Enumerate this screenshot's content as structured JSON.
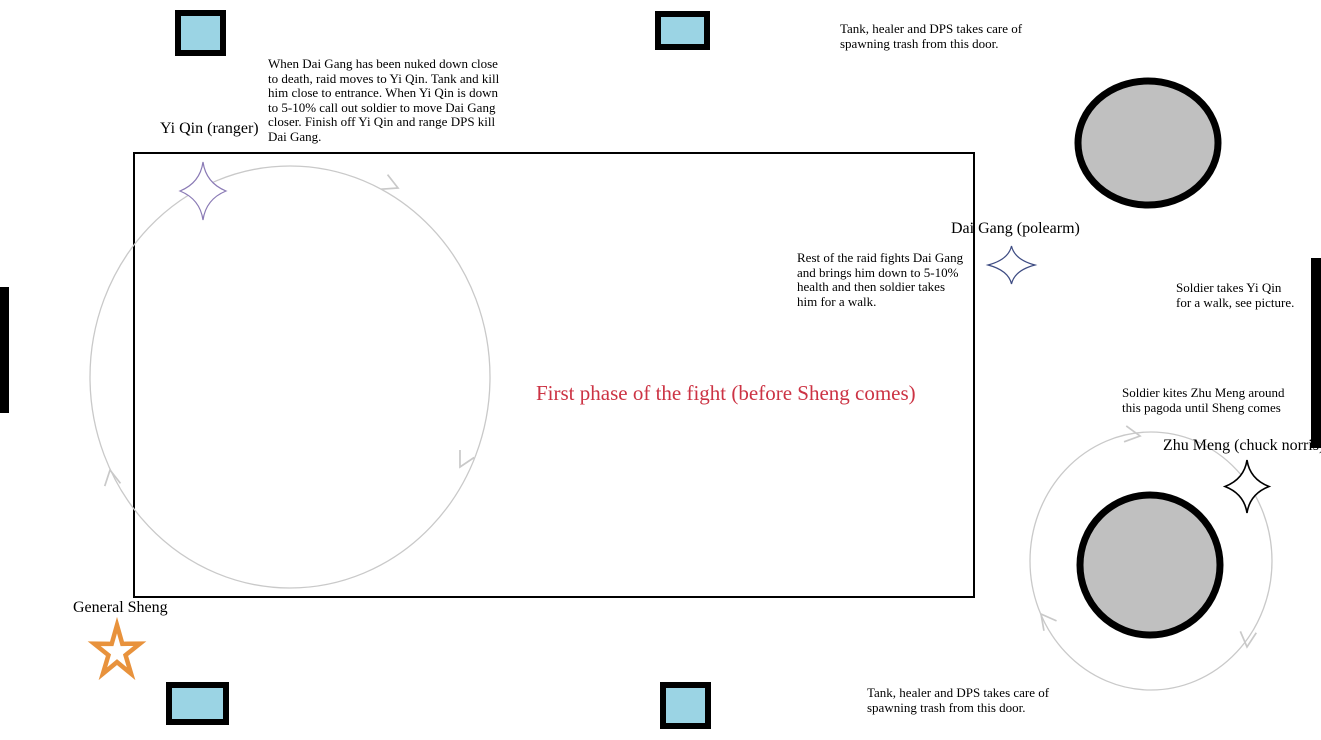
{
  "colors": {
    "door_fill": "#9bd4e4",
    "pagoda_fill": "#c0c0c0",
    "path_stroke": "#c9c9c9",
    "phase_title": "#cc3344",
    "yi_qin_star": "#8a7ab5",
    "dai_gang_star": "#3d4b82",
    "zhu_meng_star": "#000000",
    "sheng_star": "#e8923c"
  },
  "phase_title": "First phase of the fight (before Sheng comes)",
  "labels": {
    "yi_qin": "Yi Qin (ranger)",
    "dai_gang": "Dai Gang (polearm)",
    "zhu_meng": "Zhu Meng (chuck norris)",
    "general_sheng": "General Sheng"
  },
  "notes": {
    "strategy": "When Dai Gang has been nuked down close\nto death, raid moves to Yi Qin. Tank and kill\nhim close to entrance. When Yi Qin is down\nto 5-10% call out soldier to move Dai Gang\ncloser. Finish off Yi Qin and range DPS kill\nDai Gang.",
    "trash_top": "Tank, healer and DPS takes care of\nspawning trash from this door.",
    "rest_raid": "Rest of the raid fights Dai Gang\nand brings him down to 5-10%\nhealth and then soldier takes\nhim for a walk.",
    "soldier_walk": "Soldier takes Yi Qin\nfor a walk, see picture.",
    "soldier_kites": "Soldier kites Zhu Meng around\nthis pagoda until Sheng comes",
    "trash_bottom": "Tank, healer and DPS takes care of\nspawning trash from this door."
  }
}
